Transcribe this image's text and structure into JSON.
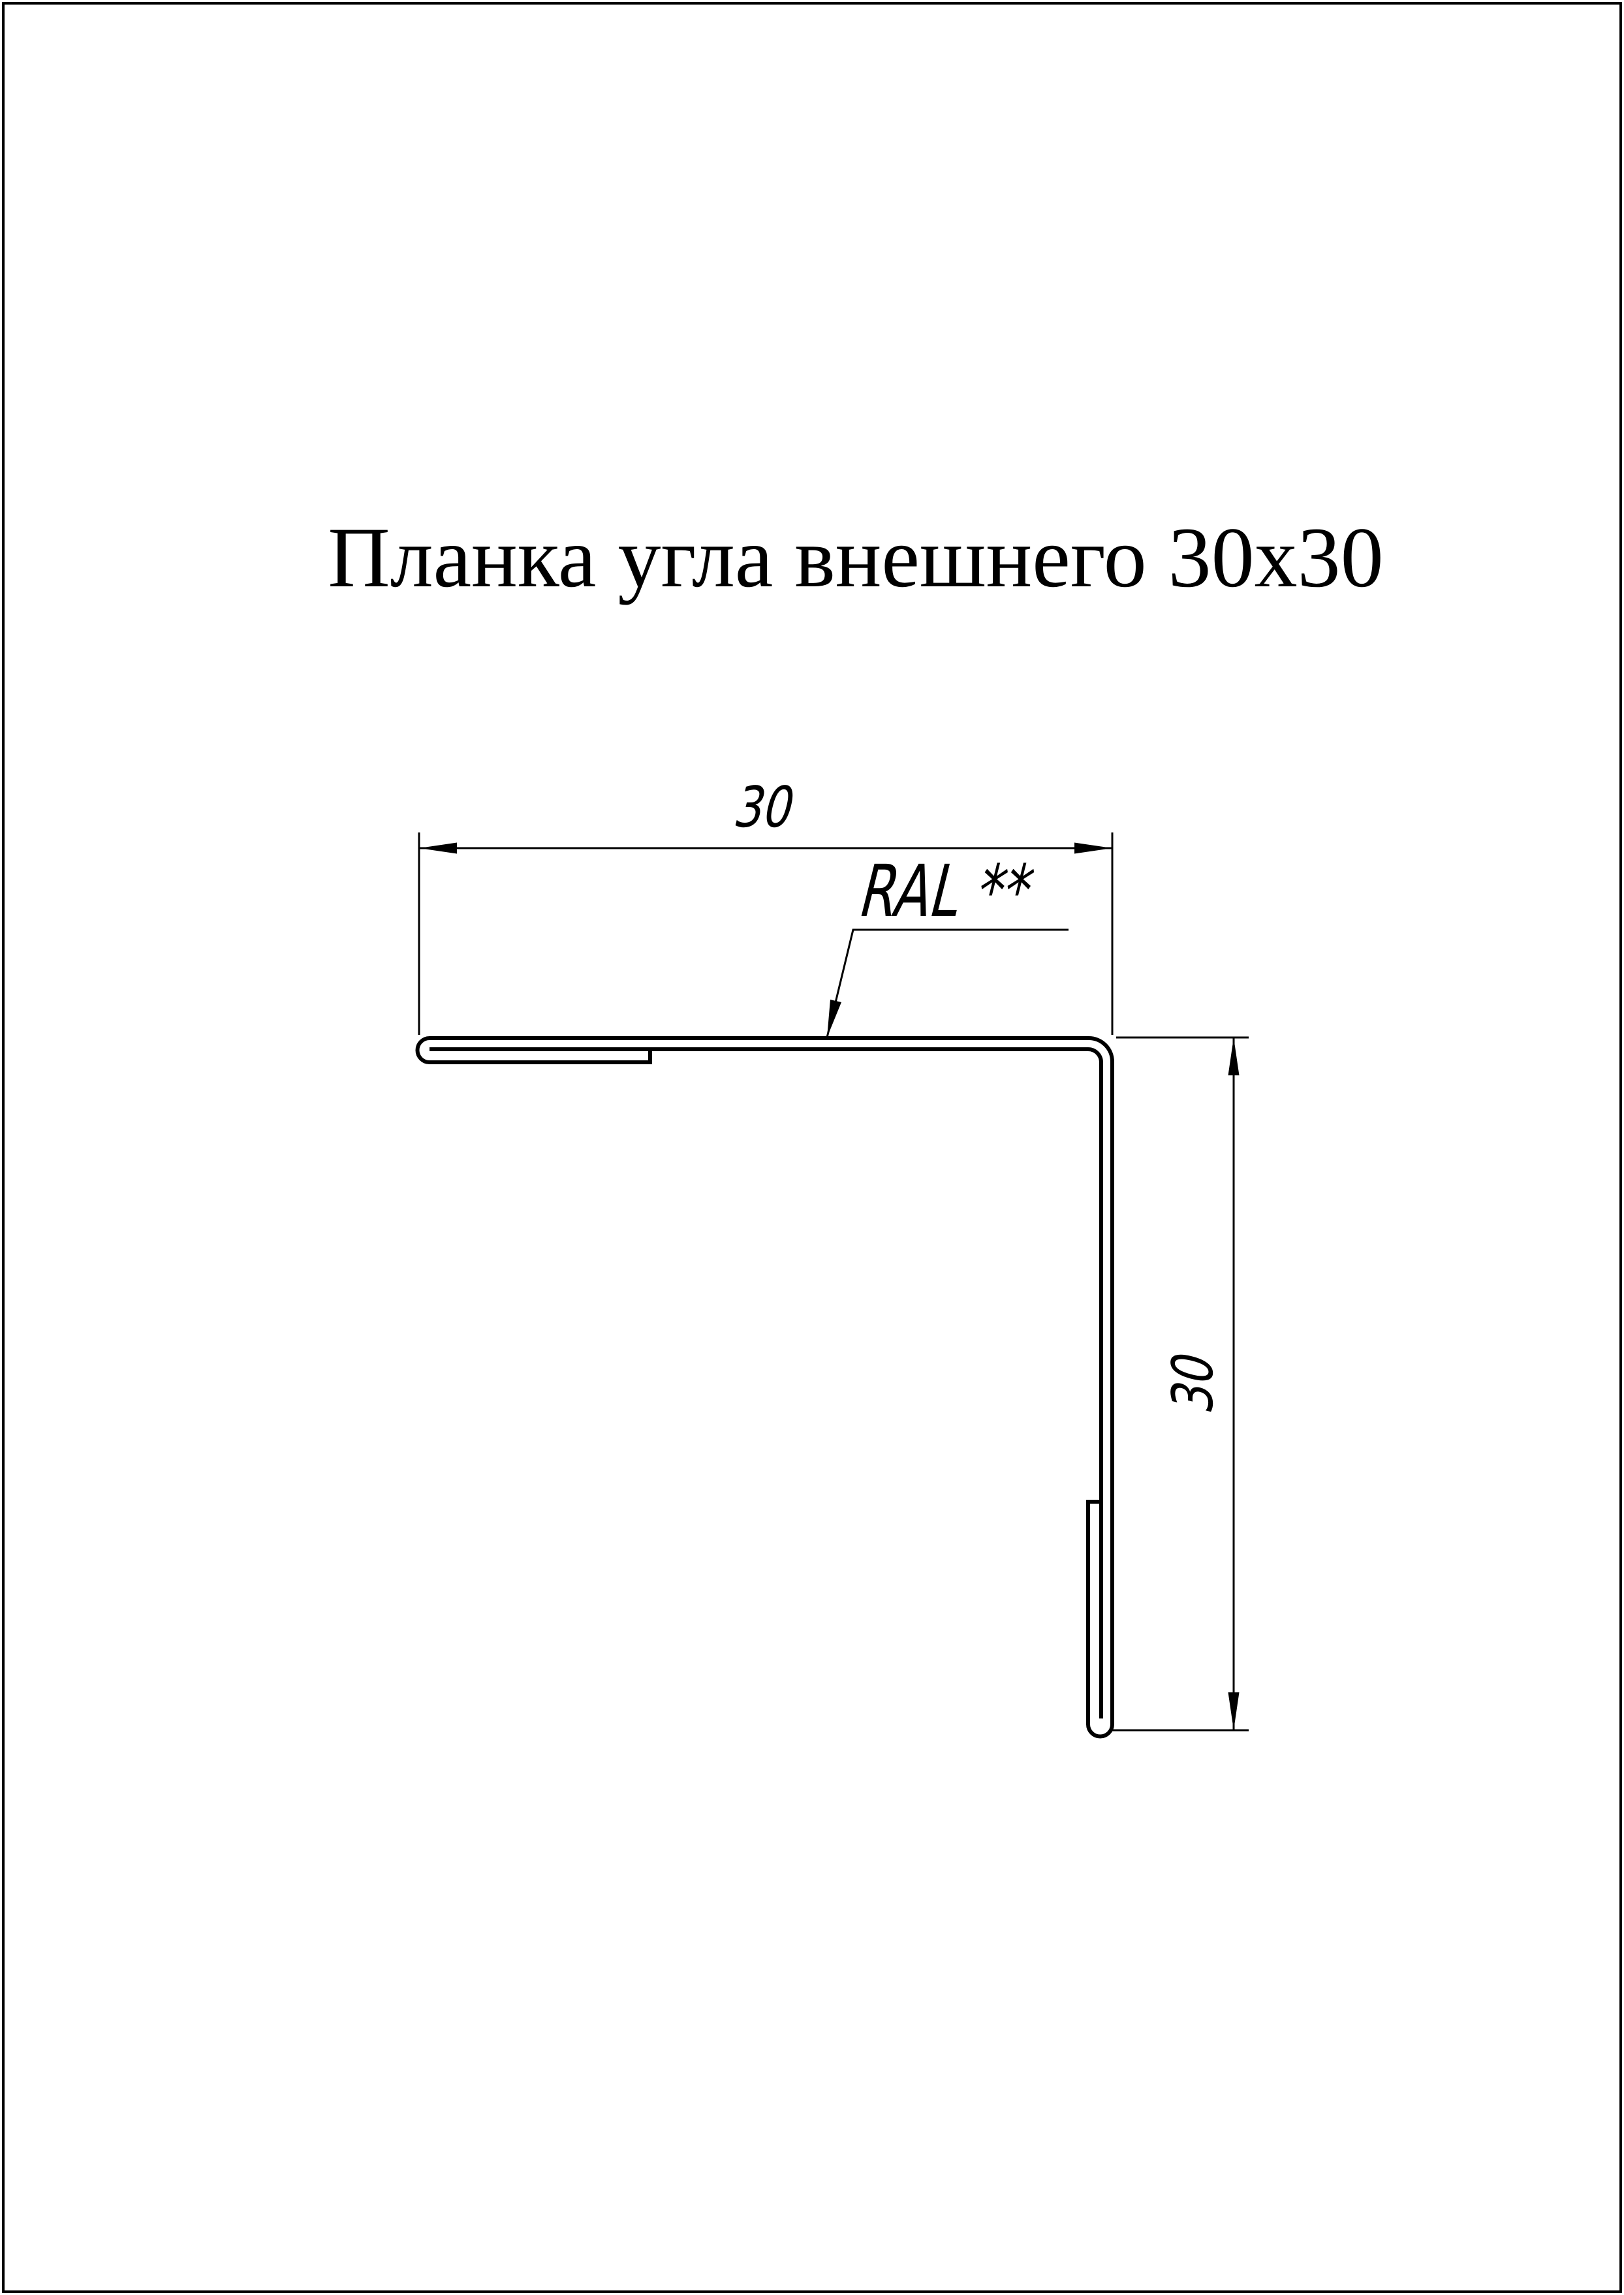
{
  "page": {
    "background": "#ffffff",
    "border_color": "#000000",
    "line_color": "#000000"
  },
  "title": "Планка угла внешнего 30х30",
  "drawing": {
    "dimensions": {
      "horizontal": "30",
      "vertical": "30"
    },
    "material_label": "RAL **"
  }
}
